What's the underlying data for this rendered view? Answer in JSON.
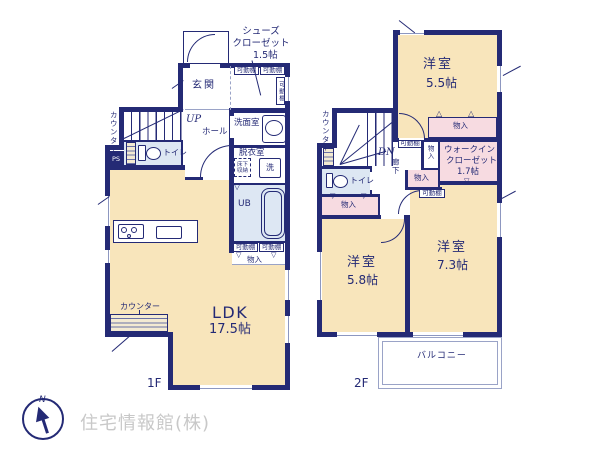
{
  "floor1": {
    "floor_label": "1F",
    "entrance": "玄関",
    "shoes_closet_name_1": "シューズ",
    "shoes_closet_name_2": "クローゼット",
    "shoes_closet_size": "1.5帖",
    "movable_shelf": "可動棚",
    "washroom": "洗面室",
    "dressing_room": "脱衣室",
    "underfloor_storage_1": "床下",
    "underfloor_storage_2": "収納",
    "washer": "洗",
    "unit_bath": "UB",
    "storage": "物入",
    "stairs_up": "UP",
    "hall": "ホール",
    "toilet": "トイレ",
    "pipe_space": "PS",
    "counter": "カウンター",
    "ldk_name": "LDK",
    "ldk_size": "17.5帖"
  },
  "floor2": {
    "floor_label": "2F",
    "room_a_name": "洋室",
    "room_a_size": "5.5帖",
    "room_b_name": "洋室",
    "room_b_size": "5.8帖",
    "room_c_name": "洋室",
    "room_c_size": "7.3帖",
    "wic_name_1": "ウォークイン",
    "wic_name_2": "クローゼット",
    "wic_size": "1.7帖",
    "storage": "物入",
    "movable_shelf": "可動棚",
    "stairs_down": "DN",
    "corridor": "廊下",
    "toilet": "トイレ",
    "counter": "カウンター",
    "balcony": "バルコニー"
  },
  "glyphs": {
    "tri_down": "▽",
    "tri_up": "△"
  },
  "colors": {
    "wall": "#242a75",
    "room_tan": "#f8e5bb",
    "closet_pink": "#f7dbe1",
    "wet_blue": "#dde7f3",
    "window_line": "#8d97c0",
    "watermark_gray": "#c8c8c8"
  },
  "footer": {
    "watermark": "住宅情報館(株)",
    "compass_north": "N"
  }
}
